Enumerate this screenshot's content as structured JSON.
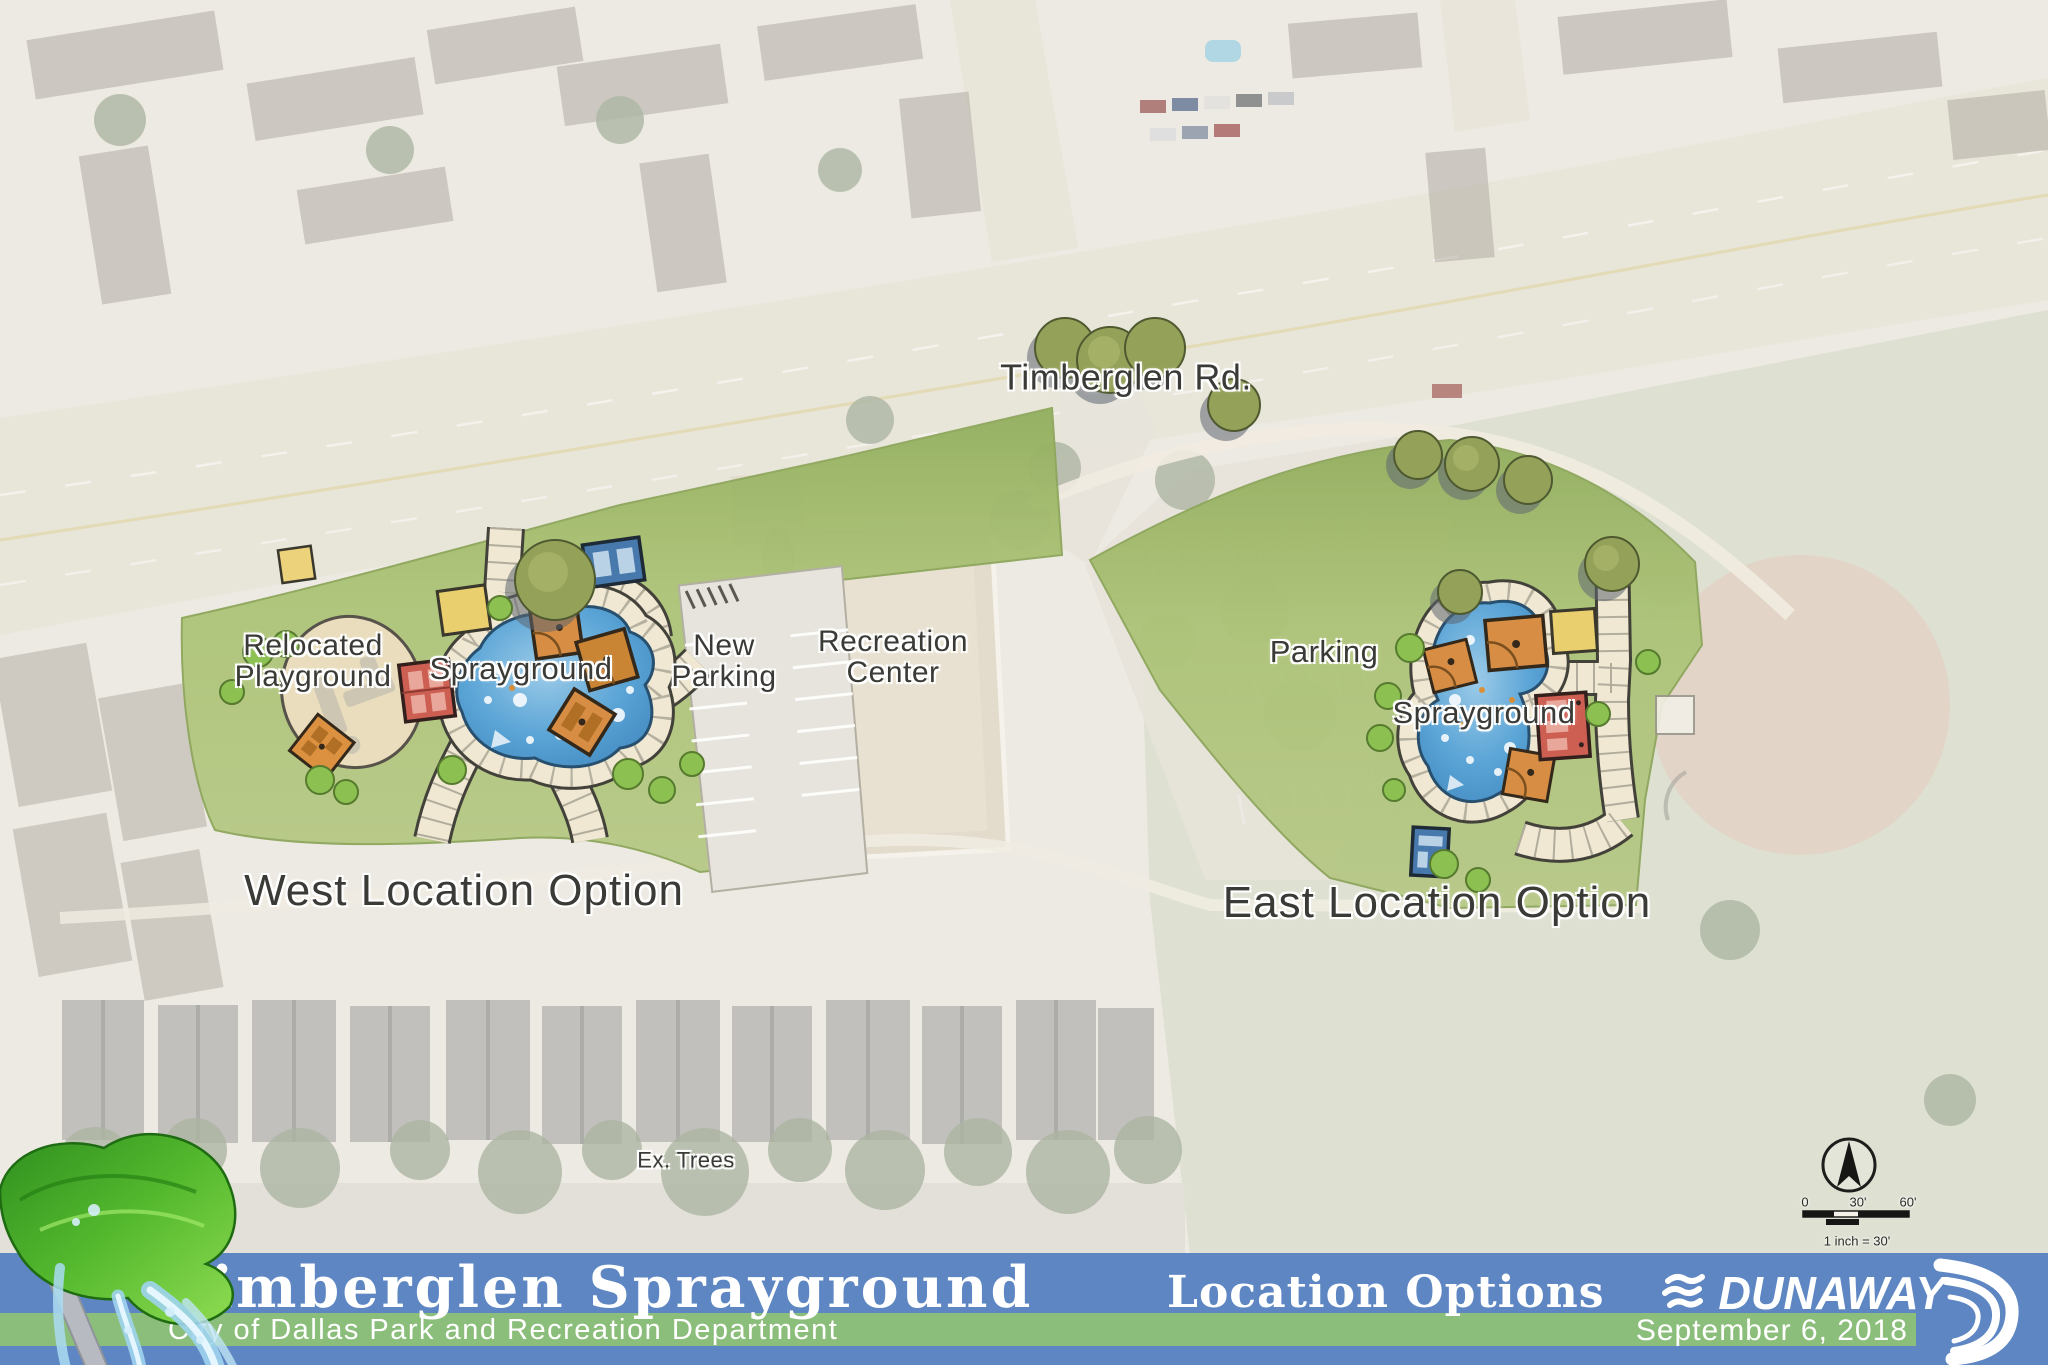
{
  "map": {
    "road_label": "Timberglen Rd.",
    "west": {
      "playground_line1": "Relocated",
      "playground_line2": "Playground",
      "sprayground_label": "Sprayground",
      "parking_line1": "New",
      "parking_line2": "Parking",
      "option_label": "West Location Option"
    },
    "rec_center_line1": "Recreation",
    "rec_center_line2": "Center",
    "parking_east_label": "Parking",
    "east": {
      "sprayground_label": "Sprayground",
      "option_label": "East Location Option"
    },
    "ex_trees_label": "Ex. Trees",
    "scale": {
      "start": "0",
      "mid": "30'",
      "end": "60'",
      "caption": "1 inch = 30'"
    }
  },
  "banner": {
    "title": "Timberglen Sprayground",
    "subtitle": "City of Dallas Park and Recreation Department",
    "sheet_name": "Location Options",
    "firm_name": "DUNAWAY",
    "date": "September 6, 2018"
  },
  "colors": {
    "banner_blue": "#5d86c2",
    "banner_green": "#8cbe7b",
    "lawn_green": "#abc276",
    "pool_blue": "#4d9fd6",
    "path_cream": "#f0e8d2",
    "shade_orange": "#d78e44",
    "shade_yellow": "#e9cf6e",
    "building_red": "#cd5f52",
    "kiosk_blue": "#4779ad"
  }
}
